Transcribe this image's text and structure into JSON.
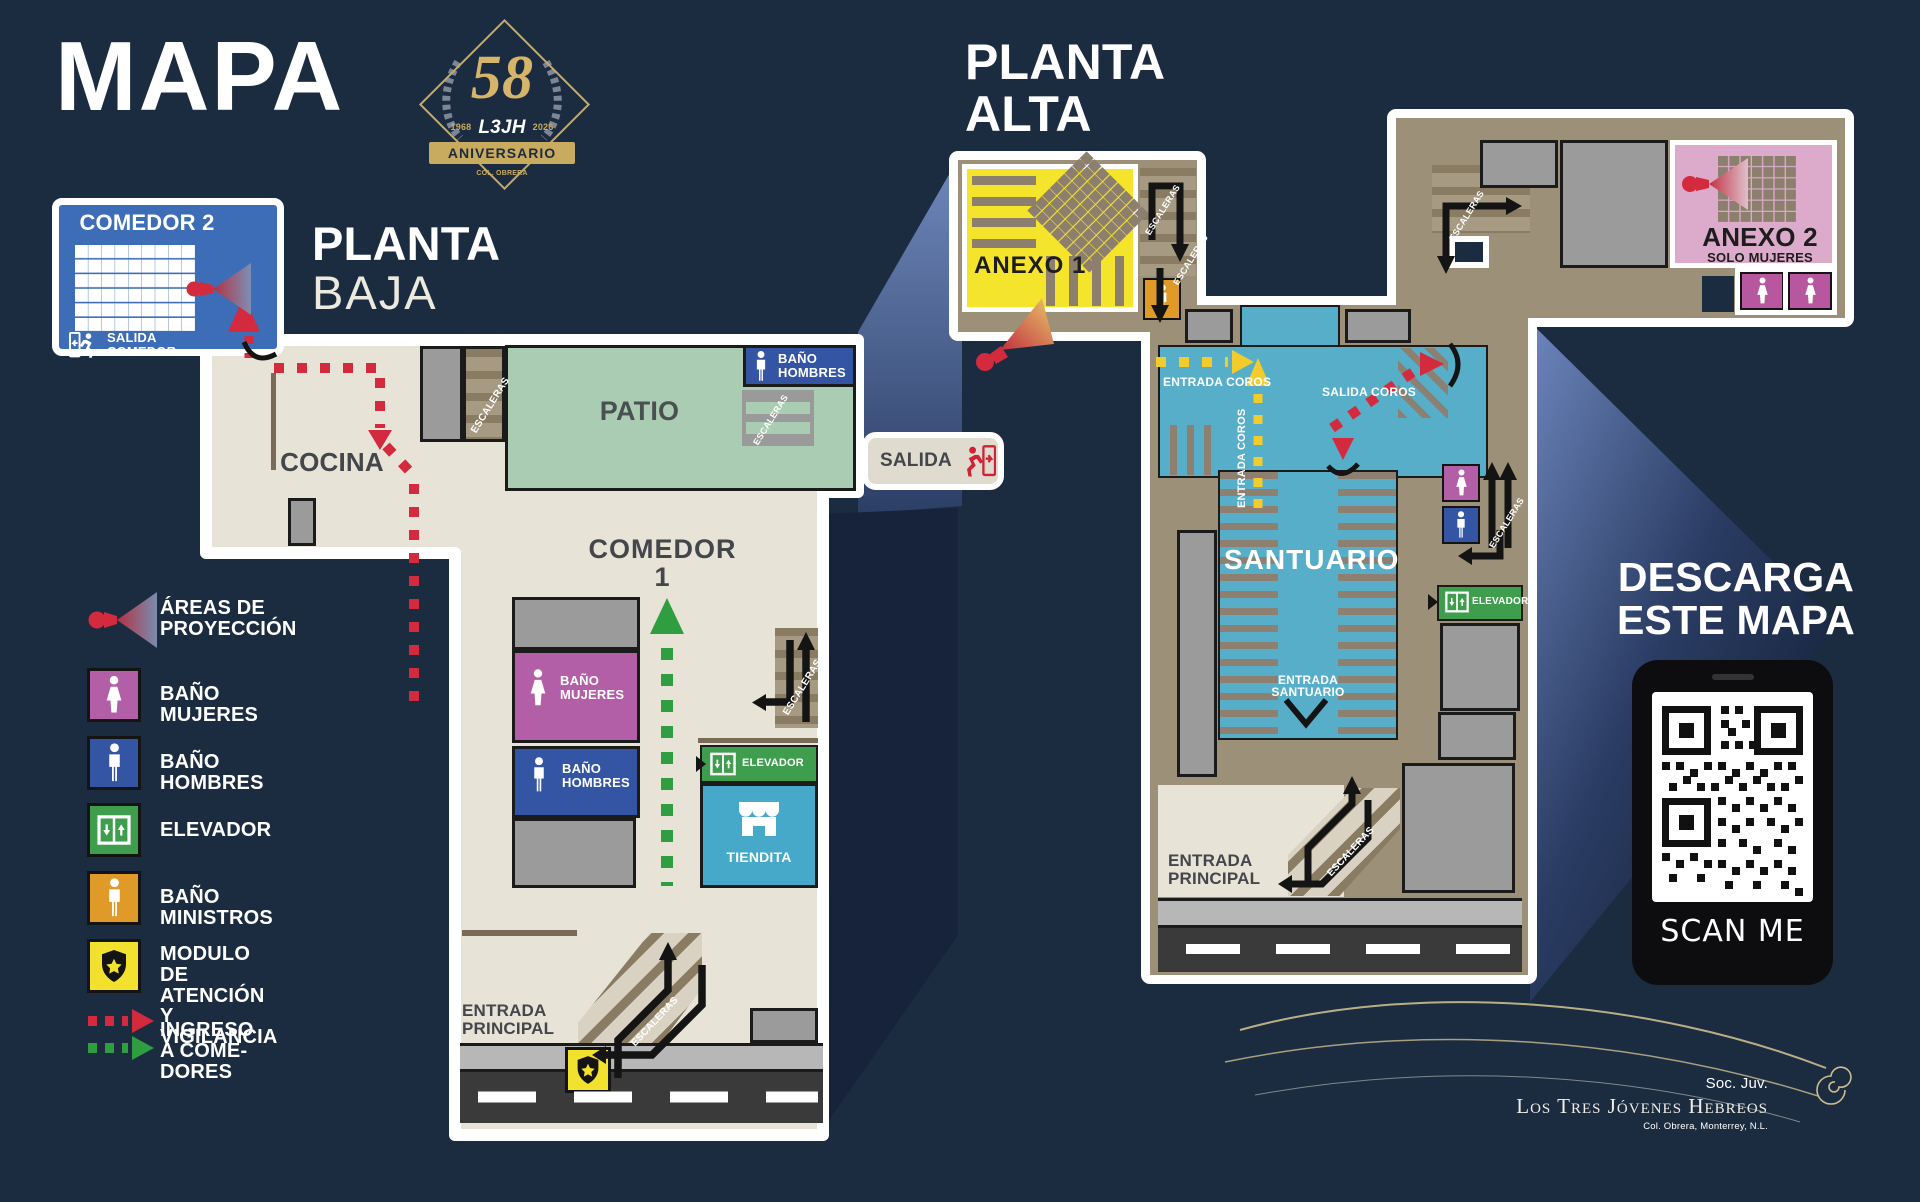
{
  "header": {
    "title": "MAPA",
    "badge": {
      "number": "58",
      "year_left": "1968",
      "initials": "L3JH",
      "year_right": "2026",
      "banner": "ANIVERSARIO",
      "footnote": "COL. OBRERA"
    }
  },
  "common": {
    "escaleras": "ESCALERAS",
    "elevador": "ELEVADOR",
    "entrada_principal": "ENTRADA\nPRINCIPAL"
  },
  "lower": {
    "title_bold": "PLANTA",
    "title_light": "BAJA",
    "comedor2": {
      "name": "COMEDOR 2",
      "exit": "SALIDA\nCOMEDOR"
    },
    "salida": "SALIDA",
    "cocina": "COCINA",
    "patio": "PATIO",
    "bano_hombres": "BAÑO\nHOMBRES",
    "comedor1": "COMEDOR 1",
    "bano_mujeres": "BAÑO\nMUJERES",
    "tiendita": "TIENDITA"
  },
  "upper": {
    "title_bold": "PLANTA",
    "title_light": "ALTA",
    "anexo1": "ANEXO 1",
    "entrada_coros": "ENTRADA COROS",
    "entrada_coros_vertical": "ENTRADA COROS",
    "salida_coros": "SALIDA COROS",
    "santuario": "SANTUARIO",
    "entrada_santuario": "ENTRADA\nSANTUARIO",
    "anexo2": "ANEXO 2",
    "anexo2_subtitle": "SOLO MUJERES"
  },
  "legend": {
    "items": [
      {
        "icon": "projector-icon",
        "label": "ÁREAS DE\nPROYECCIÓN"
      },
      {
        "icon": "woman-icon",
        "label": "BAÑO MUJERES",
        "color": "#b35fa8"
      },
      {
        "icon": "man-icon",
        "label": "BAÑO HOMBRES",
        "color": "#3455a4"
      },
      {
        "icon": "elevator-icon",
        "label": "ELEVADOR",
        "color": "#3f9e4d"
      },
      {
        "icon": "man-icon",
        "label": "BAÑO MINISTROS",
        "color": "#e09a28"
      },
      {
        "icon": "shield-icon",
        "label": "MODULO DE ATENCIÓN\nY VIGILANCIA",
        "color": "#f2e12d"
      },
      {
        "icon": "route-arrows-icon",
        "label": "INGRESO A COME­DORES"
      }
    ]
  },
  "download": {
    "line1": "DESCARGA",
    "line2": "ESTE MAPA",
    "scan_label": "SCAN ME"
  },
  "signature": {
    "org": "Soc. Juv.",
    "name": "Los Tres Jóvenes Hebreos",
    "location": "Col. Obrera, Monterrey, N.L."
  },
  "colors": {
    "background": "#1b2b40",
    "plan_floor": "#e7e3d7",
    "patio_green": "#a9ccb2",
    "upper_floor_brown": "#9d9078",
    "santuario_cyan": "#56aec9",
    "tiendita_cyan": "#46a9c9",
    "comedor2_blue": "#3d6db6",
    "bathroom_men_blue": "#3455a4",
    "bathroom_women_purple": "#b35fa8",
    "elevator_green": "#3f9e4d",
    "ministers_orange": "#e09a28",
    "security_yellow": "#f2e12d",
    "anexo1_yellow": "#f5e42c",
    "anexo2_pink": "#dcaacb",
    "route_red": "#d42a3d",
    "route_green": "#2f9e41",
    "route_yellow": "#f3cc2b",
    "gold": "#c9ab5f"
  }
}
